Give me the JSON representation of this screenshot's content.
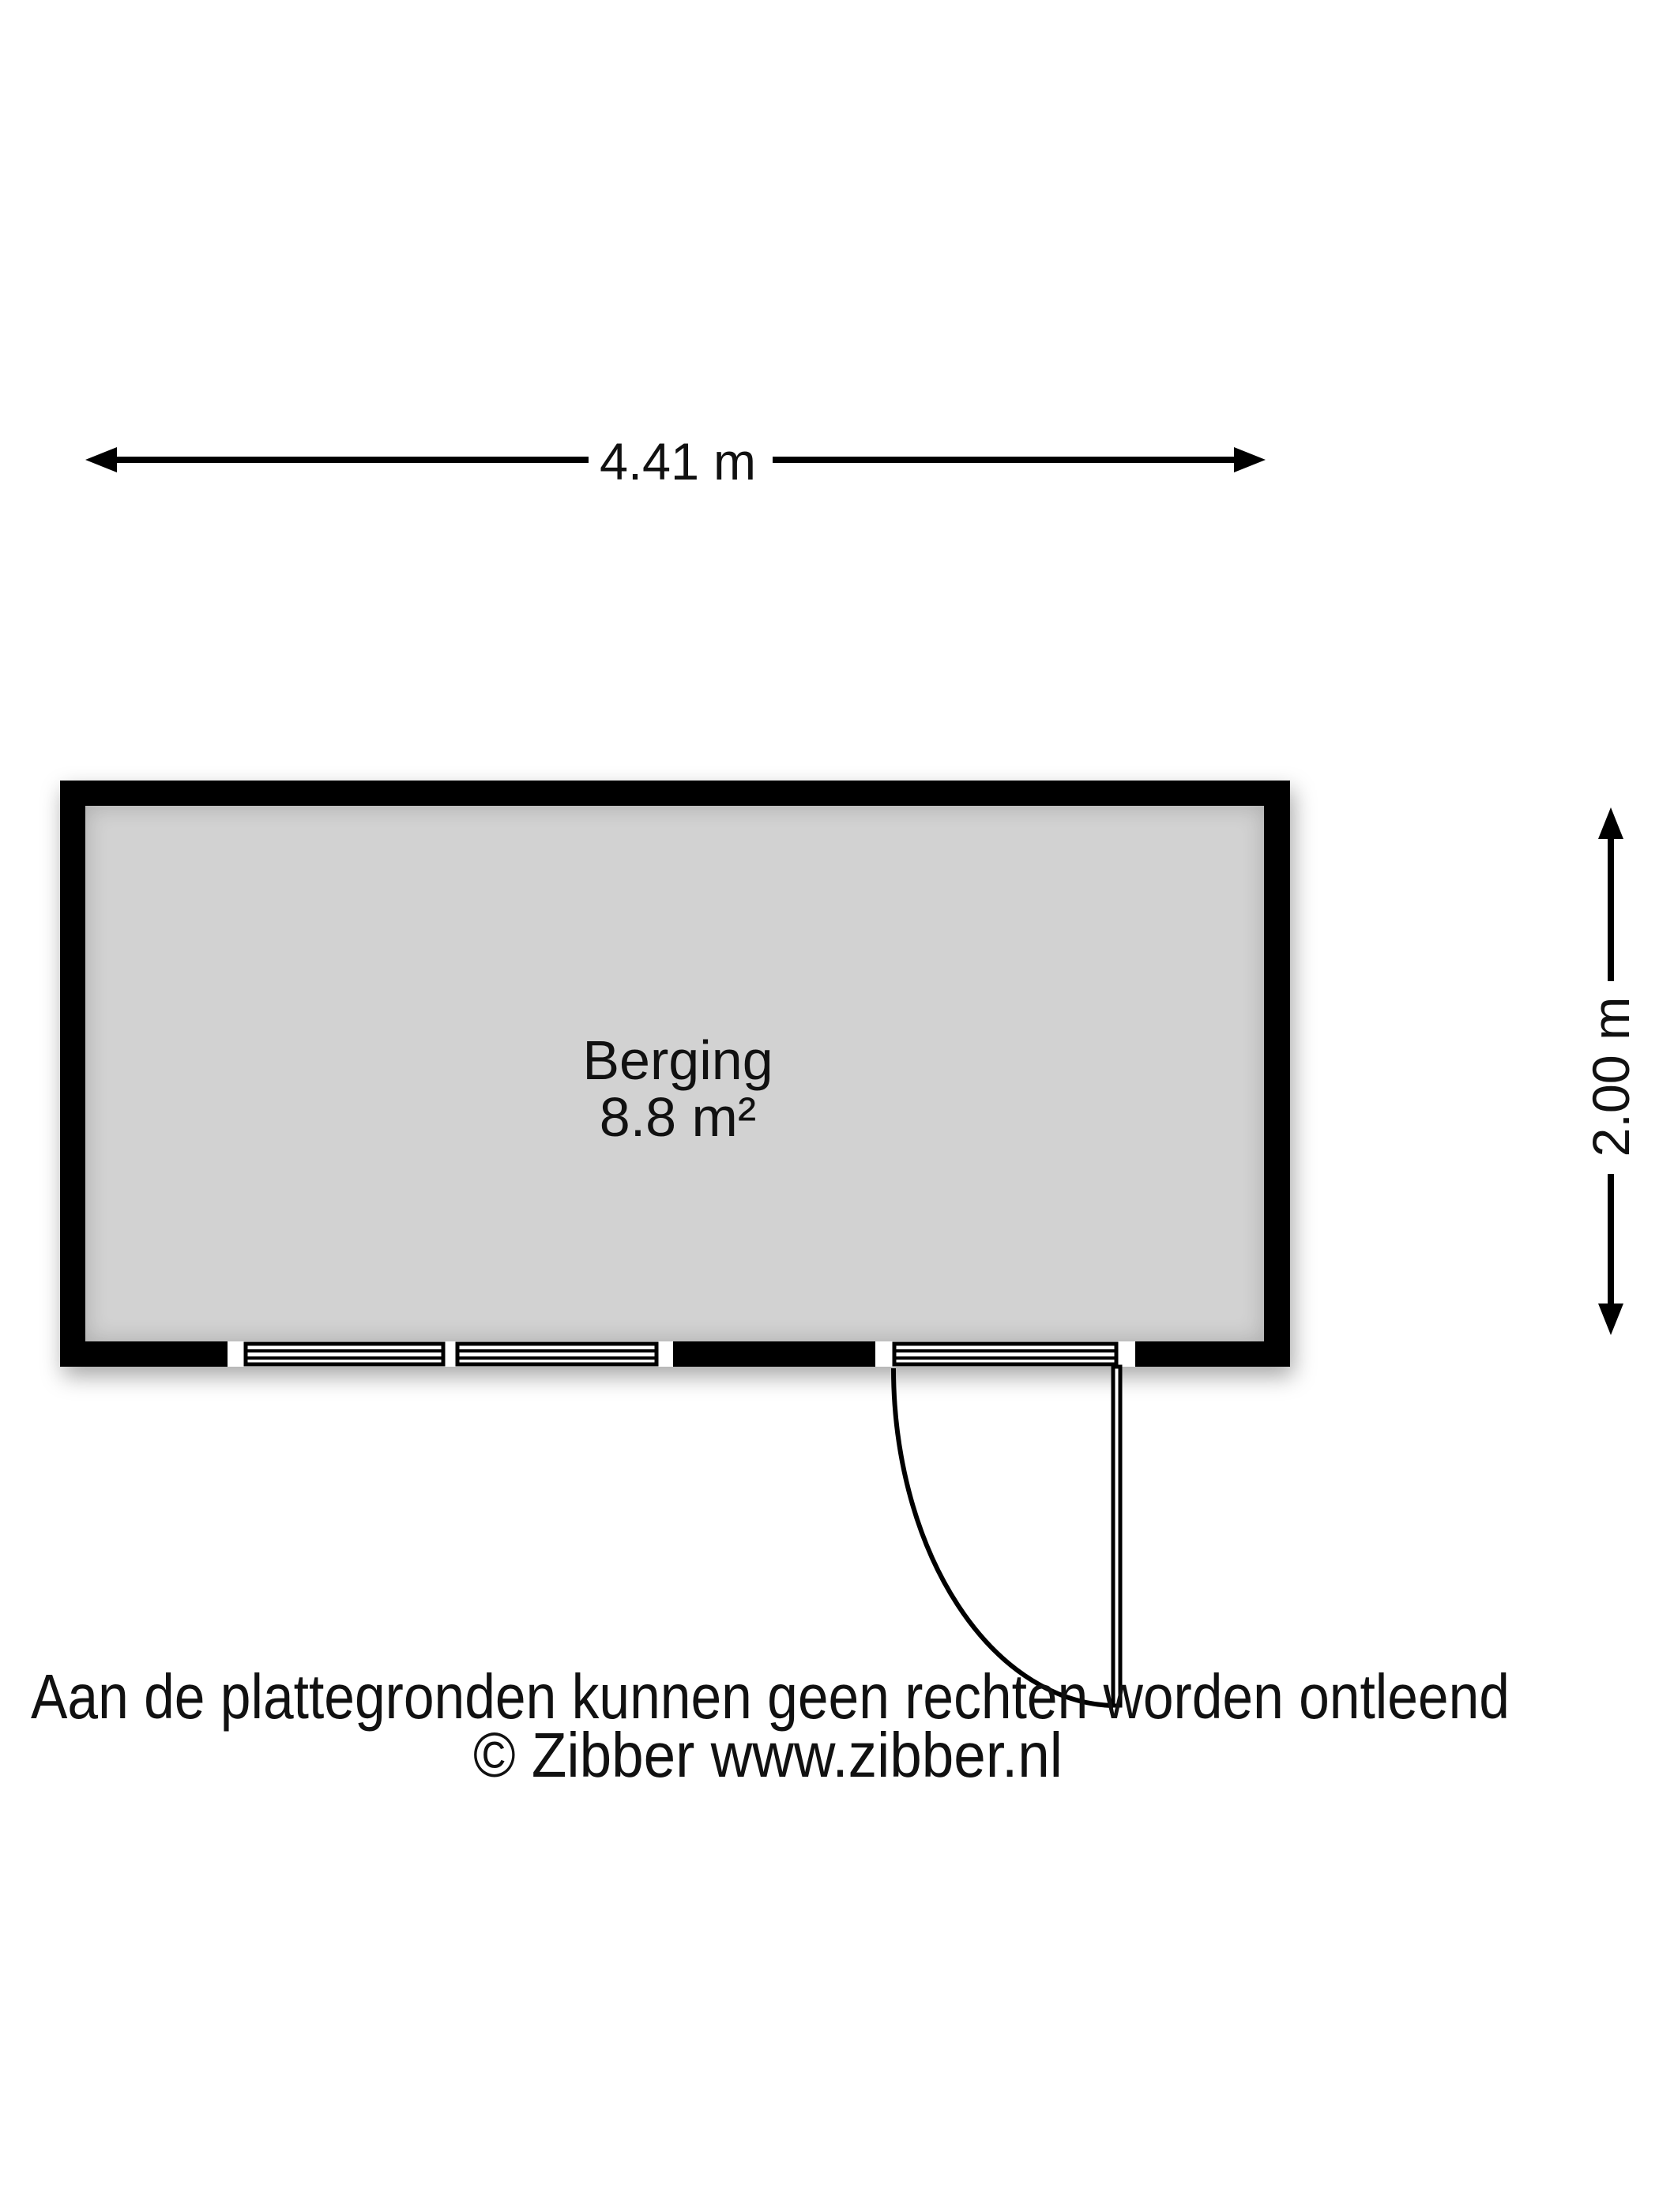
{
  "floorplan": {
    "room": {
      "name": "Berging",
      "area": "8.8 m²"
    },
    "dimensions": {
      "width_label": "4.41 m",
      "height_label": "2.00 m"
    },
    "features": [
      "window",
      "window",
      "glazed-door"
    ]
  },
  "footer": {
    "disclaimer": "Aan de plattegronden kunnen geen rechten worden ontleend",
    "copyright": "© Zibber www.zibber.nl"
  },
  "colors": {
    "wall": "#000000",
    "floor": "#d2d2d2",
    "background": "#ffffff",
    "text": "#111111"
  }
}
